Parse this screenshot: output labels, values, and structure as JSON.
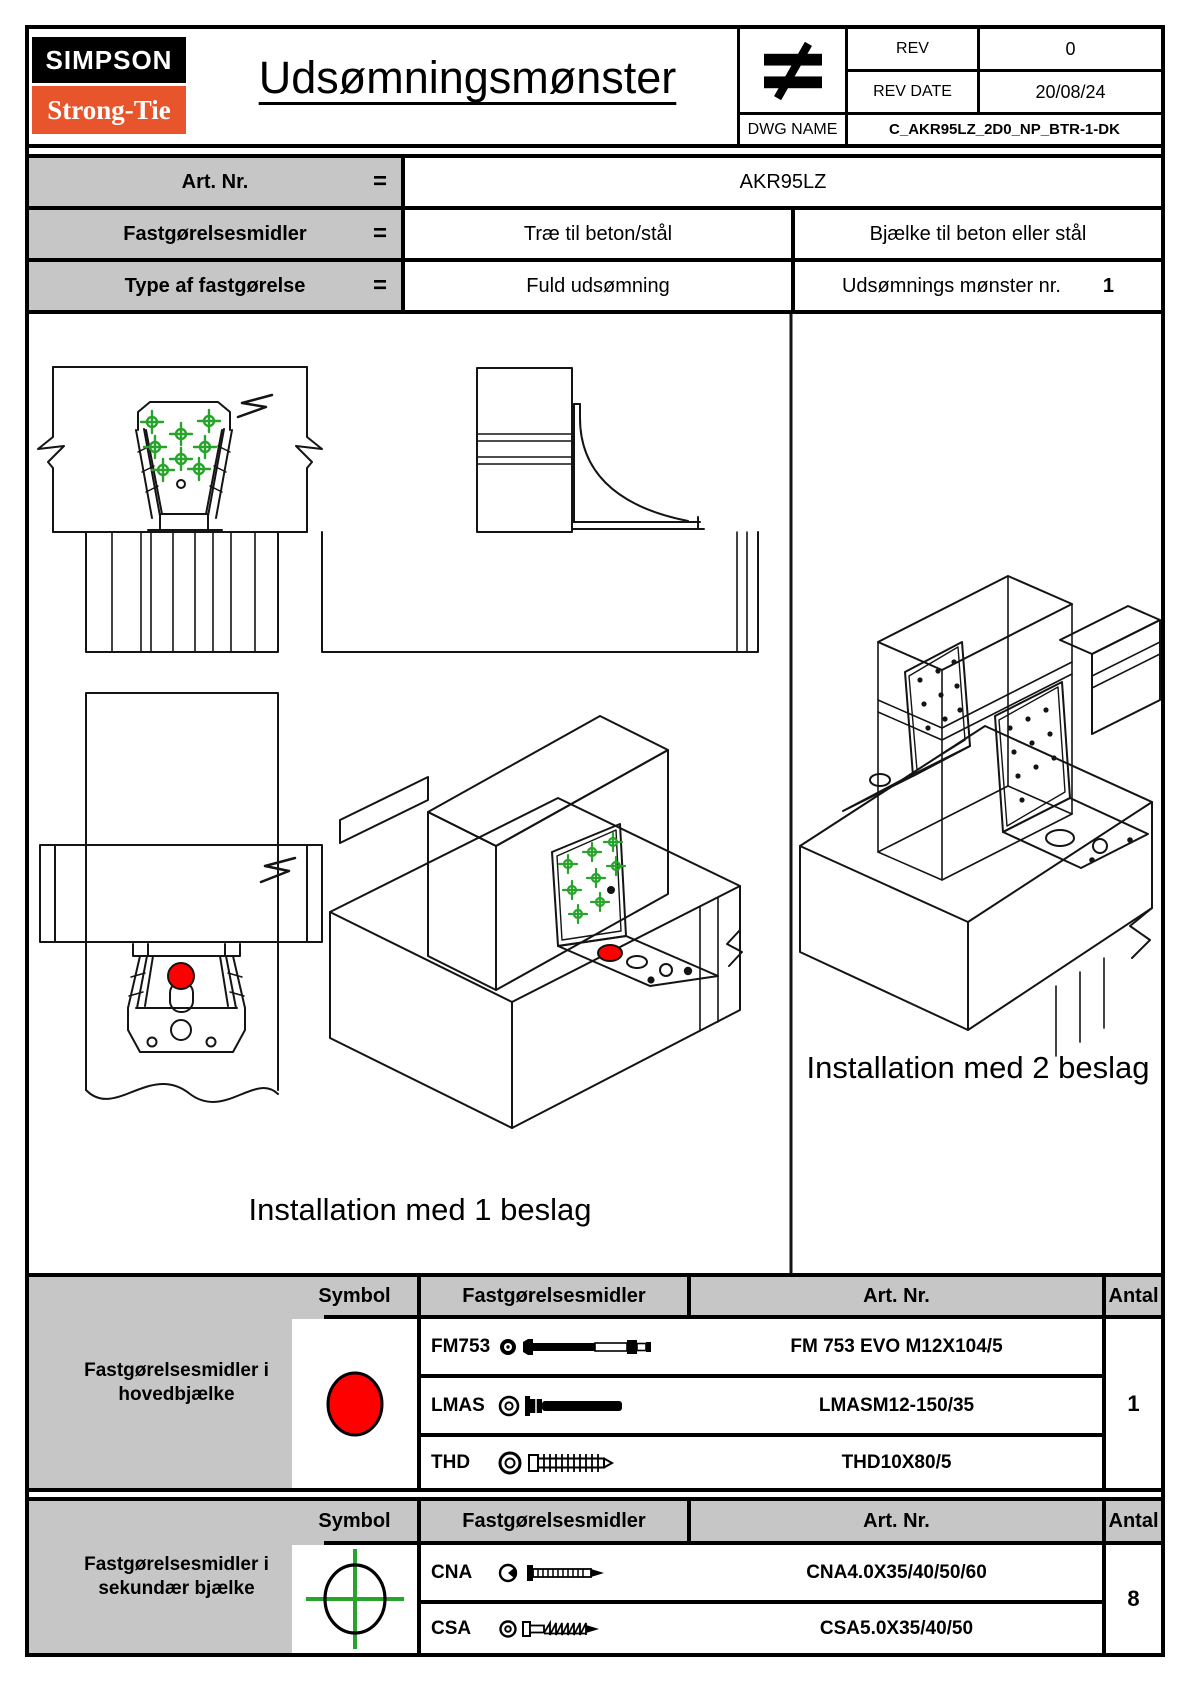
{
  "header": {
    "logo_line1": "SIMPSON",
    "logo_line2": "Strong-Tie",
    "title": "Udsømningsmønster",
    "stamp": "≠",
    "rev_label": "REV",
    "rev_value": "0",
    "rev_date_label": "REV DATE",
    "rev_date_value": "20/08/24",
    "dwg_name_label": "DWG NAME",
    "dwg_name_value": "C_AKR95LZ_2D0_NP_BTR-1-DK"
  },
  "info": {
    "rows": [
      {
        "label": "Art. Nr.",
        "eq": "=",
        "value": "AKR95LZ"
      },
      {
        "label": "Fastgørelsesmidler",
        "eq": "=",
        "value1": "Træ til beton/stål",
        "value2": "Bjælke til beton eller stål"
      },
      {
        "label": "Type af fastgørelse",
        "eq": "=",
        "value1": "Fuld udsømning",
        "value2": "Udsømnings mønster nr.",
        "value2_number": "1"
      }
    ]
  },
  "drawings": {
    "caption_one": "Installation med 1 beslag",
    "caption_two": "Installation med 2 beslag"
  },
  "tables": [
    {
      "row_label": "Fastgørelsesmidler i hovedbjælke",
      "headers": {
        "symbol": "Symbol",
        "fastener": "Fastgørelsesmidler",
        "art_nr": "Art. Nr.",
        "qty": "Antal"
      },
      "symbol": "red-filled-circle",
      "rows": [
        {
          "code": "FM753",
          "icon": "bolt-with-threaded-end",
          "art_nr": "FM 753 EVO M12X104/5"
        },
        {
          "code": "LMAS",
          "icon": "anchor-bolt",
          "art_nr": "LMASM12-150/35"
        },
        {
          "code": "THD",
          "icon": "concrete-screw",
          "art_nr": "THD10X80/5"
        }
      ],
      "qty": "1"
    },
    {
      "row_label": "Fastgørelsesmidler i sekundær bjælke",
      "headers": {
        "symbol": "Symbol",
        "fastener": "Fastgørelsesmidler",
        "art_nr": "Art. Nr.",
        "qty": "Antal"
      },
      "symbol": "green-crosshair-circle",
      "rows": [
        {
          "code": "CNA",
          "icon": "ring-shank-nail",
          "art_nr": "CNA4.0X35/40/50/60"
        },
        {
          "code": "CSA",
          "icon": "screw",
          "art_nr": "CSA5.0X35/40/50"
        }
      ],
      "qty": "8"
    }
  ],
  "colors": {
    "accent_red": "#fe0000",
    "accent_green": "#28a32c",
    "brand_orange": "#e8542b",
    "cell_gray": "#c6c6c6"
  }
}
